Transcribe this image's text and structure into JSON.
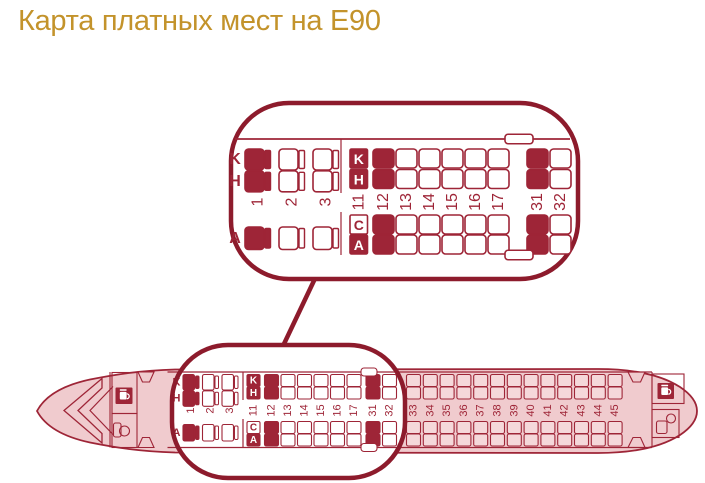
{
  "title": "Карта платных мест на Е90",
  "colors": {
    "accent": "#9E2537",
    "accent_dark": "#8D1B2C",
    "gold": "#C3932B",
    "fuselage_fill": "#F0CBCE",
    "pink_seat_fill": "#F5D8DA",
    "white": "#FFFFFF"
  },
  "seat_map": {
    "aircraft": "E90",
    "letters_top": [
      "K",
      "H"
    ],
    "letters_bottom": [
      "C",
      "A"
    ],
    "business": {
      "rows": [
        "1",
        "2",
        "3"
      ],
      "letters_top": [
        "K",
        "H"
      ],
      "letters_bottom": [
        "A"
      ],
      "paid_rows": [
        "1"
      ]
    },
    "economy": {
      "letter_row": "11",
      "letter_row_seats": [
        {
          "letter": "K",
          "paid": true
        },
        {
          "letter": "H",
          "paid": true
        },
        {
          "letter": "C",
          "paid": false
        },
        {
          "letter": "A",
          "paid": true
        }
      ],
      "zoom_rows": [
        "12",
        "13",
        "14",
        "15",
        "16",
        "17",
        "31",
        "32"
      ],
      "rear_rows": [
        "33",
        "34",
        "35",
        "36",
        "37",
        "38",
        "39",
        "40",
        "41",
        "42",
        "43",
        "44",
        "45"
      ],
      "paid_full_rows": [
        "12",
        "31"
      ]
    },
    "features": {
      "front": [
        "door-icon",
        "galley-icon",
        "lavatory-icon",
        "cockpit-windshield"
      ],
      "rear": [
        "door-icon",
        "galley-icon",
        "lavatory-icon"
      ],
      "overwing_exit_markers": 4
    }
  }
}
